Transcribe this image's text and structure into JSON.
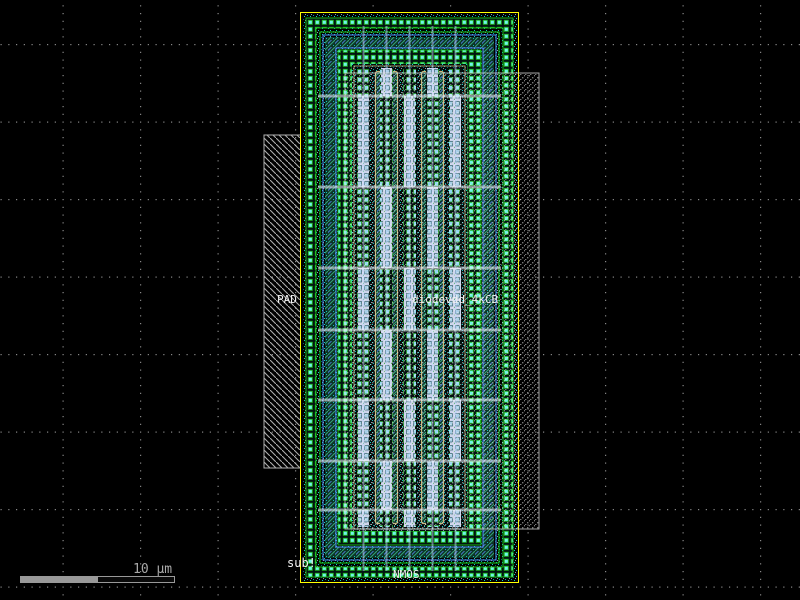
{
  "app": {
    "view": "ic-layout-canvas"
  },
  "labels": {
    "pad": "PAD",
    "cell_name": "diodevdd_4kCB",
    "substrate": "sub!",
    "device": "NMOS"
  },
  "scale_bar": {
    "label": "10 µm"
  },
  "canvas": {
    "background": "#000000",
    "grid_dot_color": "#888888",
    "grid_spacing_px": 77.5
  },
  "colors": {
    "cell_boundary": "#ffff00",
    "guard_ring_contact": "#6ef5e8",
    "guard_ring_outline": "#21b321",
    "metal_route_blue": "#5599ff",
    "well_hatch_green": "#35a07a",
    "diffusion_contact": "#8fd8f2",
    "metal_fill_lavender": "#ccd3ec",
    "poly_outline": "#c9b97c",
    "pad_hatch": "#cdcdcd",
    "label_text": "#f2f2f2",
    "scale_bar_gray": "#999999"
  }
}
